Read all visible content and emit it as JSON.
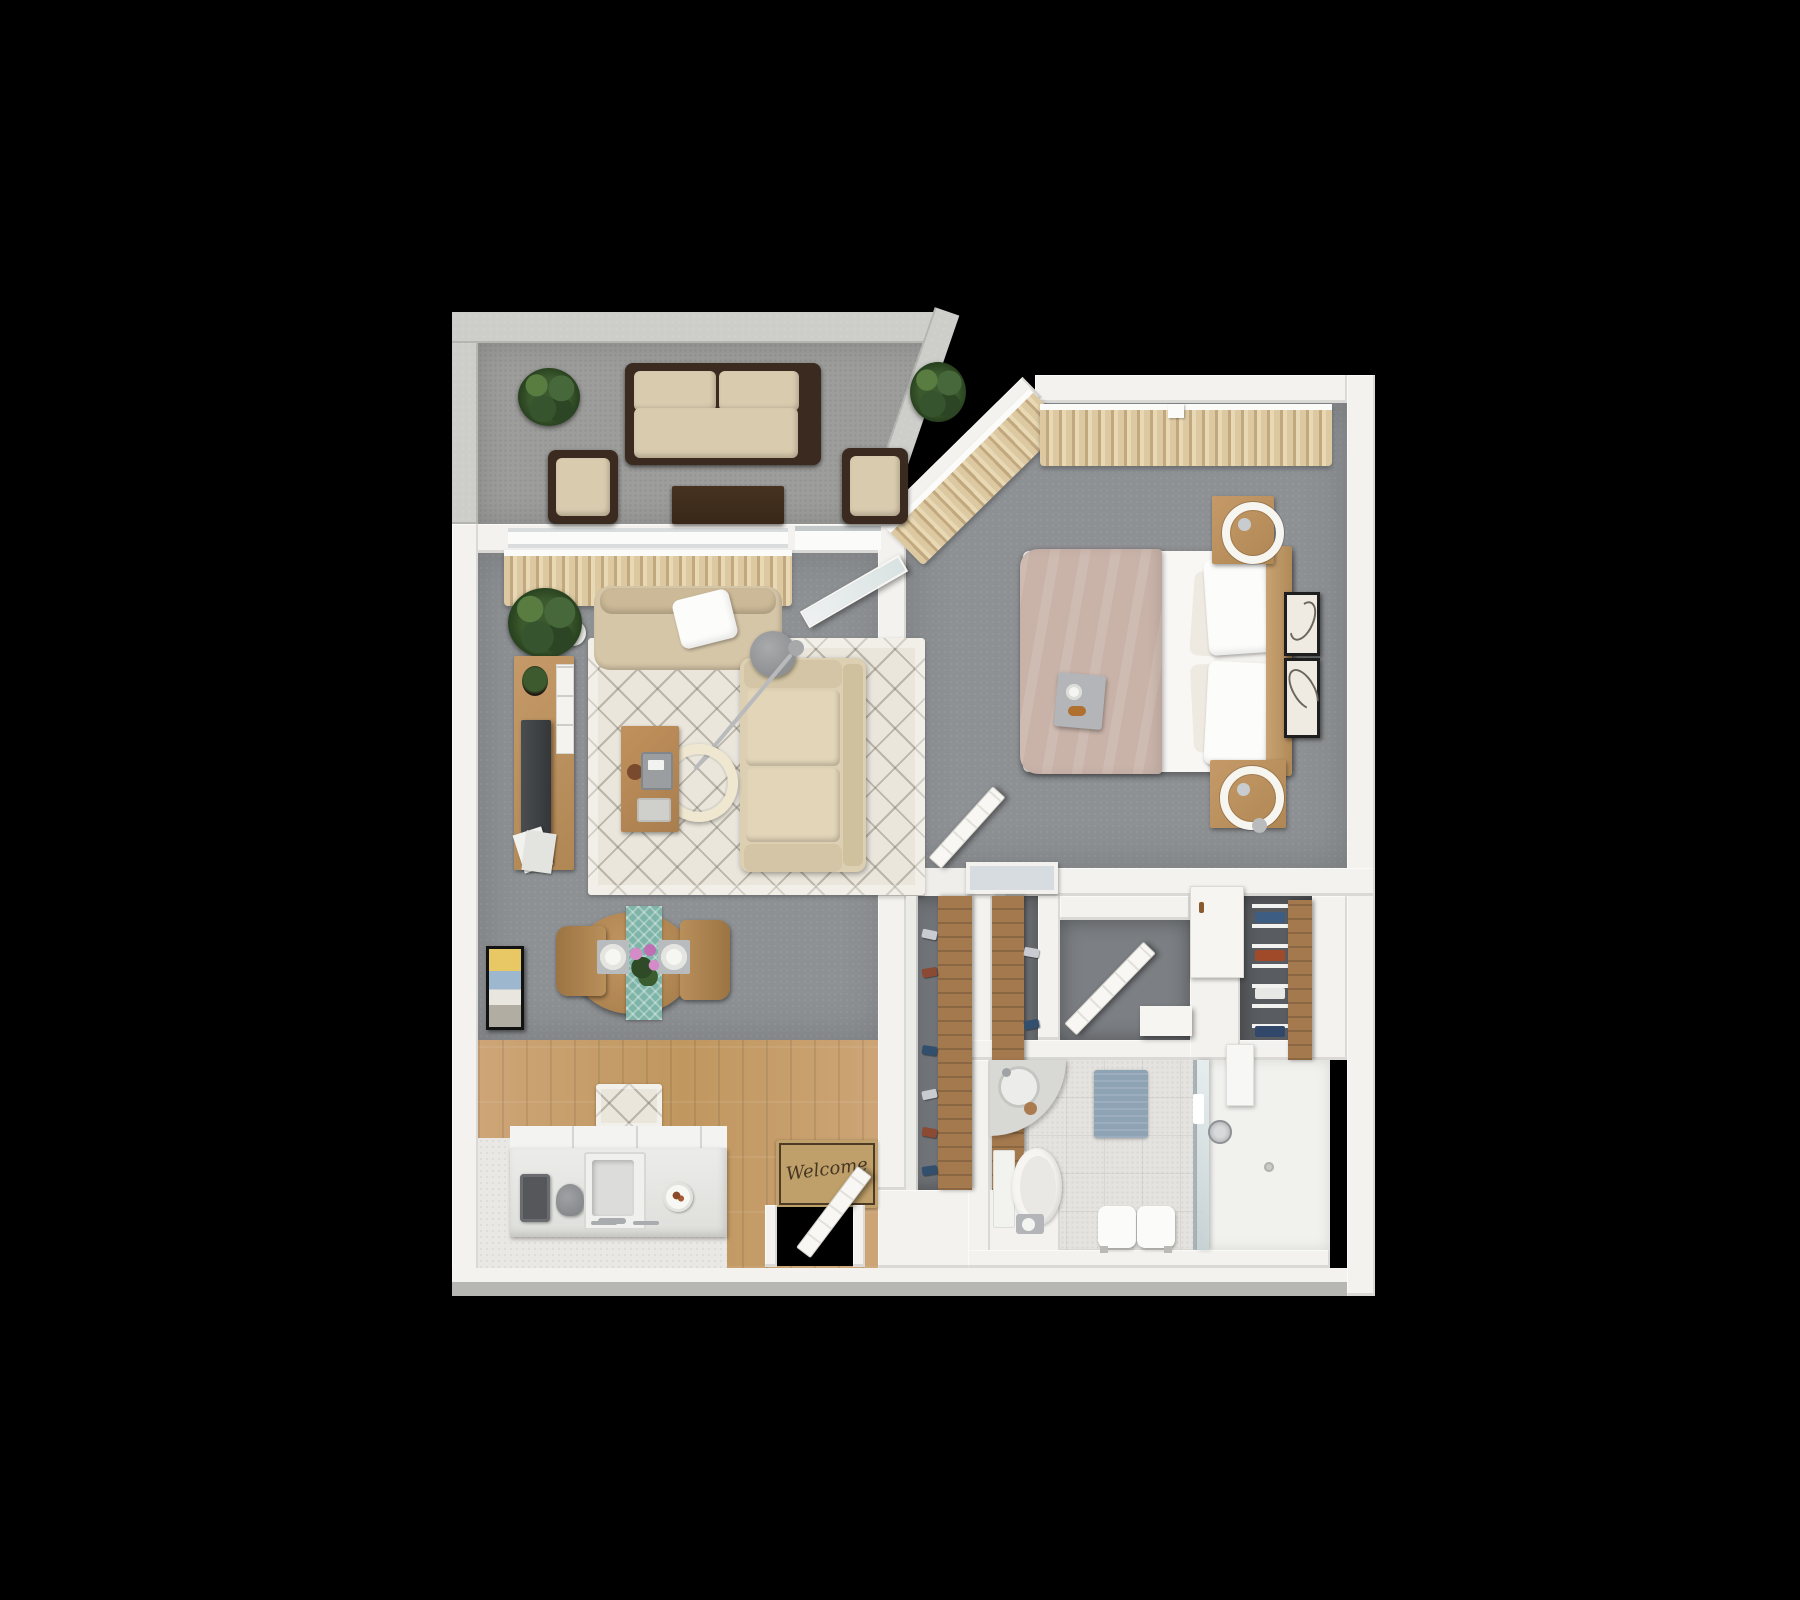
{
  "scene": {
    "type": "3d-floor-plan-render",
    "description": "Top-down 3D rendered floor plan of a one-bedroom, one-bathroom apartment with balcony, on a black background"
  },
  "labels": {
    "welcome_mat": "Welcome"
  },
  "rooms": [
    {
      "name": "balcony",
      "floor": "gray-concrete",
      "items": [
        "potted-plant",
        "outdoor-sofa-dark-frame-beige-cushions",
        "outdoor-armchair",
        "outdoor-armchair",
        "outdoor-coffee-table-dark-wood",
        "corner-potted-plant"
      ]
    },
    {
      "name": "living-room",
      "floor": "gray-carpet",
      "items": [
        "window-with-beige-curtains",
        "open-glass-balcony-door",
        "potted-plant",
        "beige-armchair-with-white-throw-pillow",
        "cream-diamond-pattern-area-rug",
        "beige-sofa",
        "round-gray-side-table",
        "arc-floor-lamp-cream-shade",
        "wood-coffee-table-with-coffee-maker",
        "wood-tv-console-with-tv-plant-white-drawers",
        "magazine-stack",
        "abstract-wall-art"
      ]
    },
    {
      "name": "dining-area",
      "floor": "gray-carpet",
      "items": [
        "round-wood-dining-table",
        "teal-table-runner",
        "dining-chair",
        "dining-chair",
        "place-setting",
        "place-setting",
        "pink-flower-centerpiece"
      ]
    },
    {
      "name": "kitchen",
      "floor": "wood-laminate-and-white-tile",
      "items": [
        "white-kitchen-counter",
        "toaster",
        "stand-mixer",
        "double-basin-sink-with-faucet",
        "plate-of-food",
        "small-diamond-pattern-rug"
      ]
    },
    {
      "name": "entry",
      "floor": "wood-laminate",
      "items": [
        "welcome-mat",
        "open-white-entry-door"
      ]
    },
    {
      "name": "bedroom",
      "floor": "gray-carpet",
      "items": [
        "angled-corner-windows-with-beige-curtains",
        "bed-with-blush-duvet-and-white-sheets",
        "four-white-pillows",
        "wood-headboard",
        "breakfast-tray-on-bed",
        "wood-nightstand-with-ring-lamp",
        "wood-nightstand-with-ring-lamp",
        "framed-line-art",
        "framed-line-art",
        "open-bedroom-door",
        "white-framed-floor-mirror"
      ]
    },
    {
      "name": "closet-hall",
      "floor": "dark-gray-carpet",
      "items": [
        "shoe-shelf-closet",
        "shoe-shelf-closet",
        "white-linen-cabinet",
        "clothes-shelf-closet",
        "open-door-to-bathroom",
        "white-threshold-step"
      ]
    },
    {
      "name": "bathroom",
      "floor": "white-tile",
      "items": [
        "corner-vanity-sink",
        "toilet",
        "toilet-paper-holder",
        "blue-bath-mat",
        "bench-with-white-towels",
        "glass-shower-screen",
        "walk-in-shower",
        "shower-head",
        "wall-shelf"
      ]
    }
  ],
  "palette": {
    "wall": "#f3f2ee",
    "parapet": "#cdcdca",
    "balconyFloor": "#9d9d9b",
    "carpet": "#8e9194",
    "closetFloor": "#707377",
    "wood": "#c89f73",
    "woodPanel": "#a5794e",
    "tile": "#e9e8e4",
    "bathTile": "#e4e3df",
    "curtain": "#dcc9a2",
    "curtainDark": "#c2a87e",
    "rug": "#eae6dc",
    "sofaBeige": "#dccfb2",
    "cushion": "#d9cbae",
    "patioFrame": "#3a2a1f",
    "patioTable": "#3c2b1c",
    "tableWood": "#bb8f5c",
    "headboard": "#c09a6a",
    "duvet": "#c9b3a9",
    "sheet": "#f8f7f4",
    "teal": "#7fb5a8",
    "matBlue": "#8ea3b4",
    "glass": "#cfd9dd",
    "tv": "#3f4245",
    "doorWhite": "#f8f7f4",
    "matTan": "#bfa06a",
    "matBorder": "#4e3b26",
    "background": "#000000"
  }
}
